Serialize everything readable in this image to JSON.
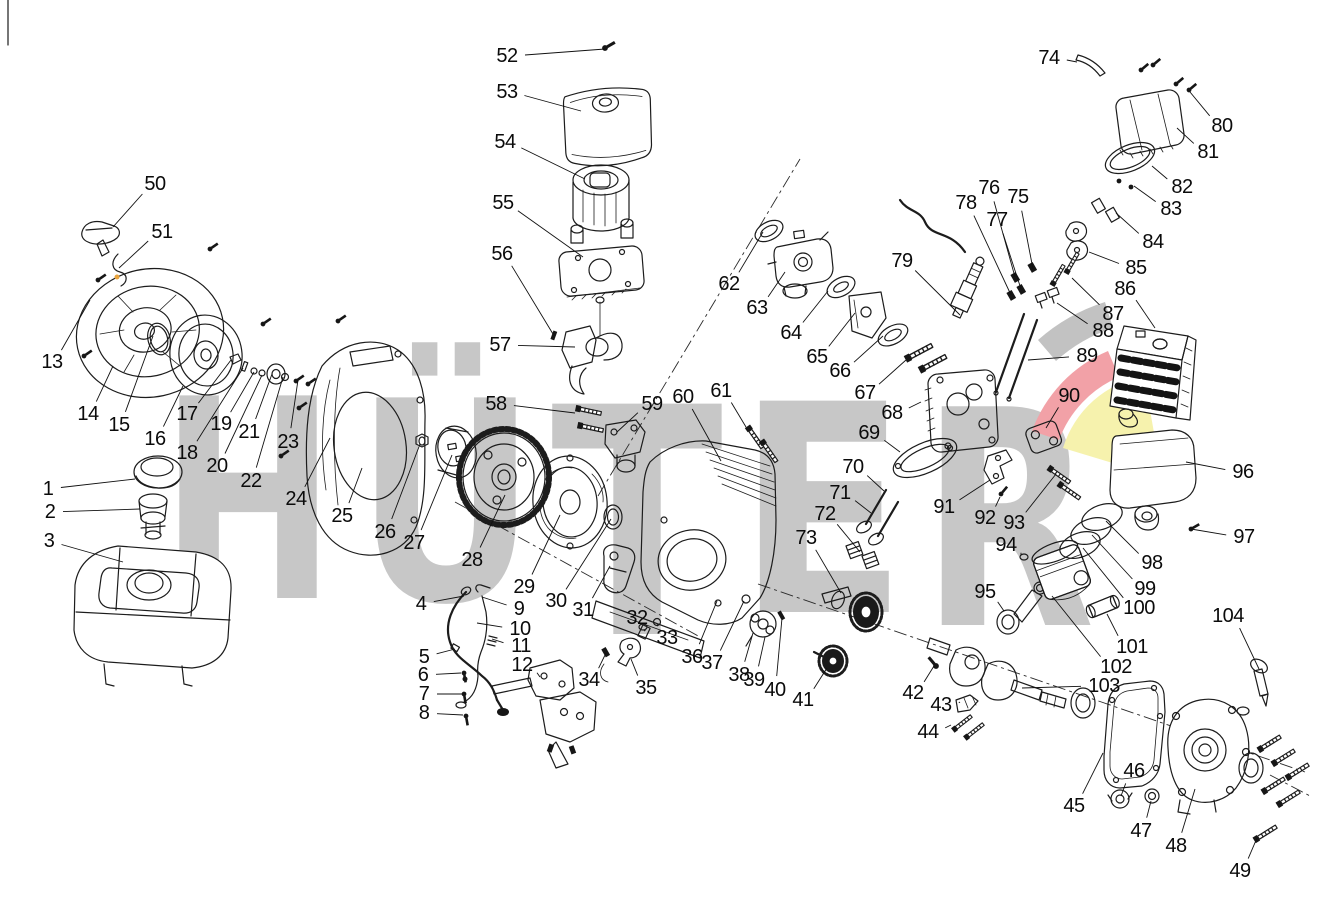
{
  "watermark": {
    "text": "HÜTER",
    "color": "#c7c7c7",
    "swoosh": {
      "gray": "#c2c2c2",
      "red": "#f2a1a7",
      "yellow": "#f6f2ad"
    },
    "letters": [
      {
        "ch": "H",
        "x": 160,
        "baseline": 598,
        "size": 278,
        "width": 176
      },
      {
        "ch": "Ü",
        "x": 356,
        "baseline": 600,
        "size": 278,
        "width": 180
      },
      {
        "ch": "T",
        "x": 551,
        "baseline": 634,
        "size": 316,
        "width": 172
      },
      {
        "ch": "E",
        "x": 737,
        "baseline": 612,
        "size": 290,
        "width": 170
      },
      {
        "ch": "R",
        "x": 921,
        "baseline": 625,
        "size": 300,
        "width": 174
      }
    ]
  },
  "diagram": {
    "background": "#ffffff",
    "stroke": "#1c1c1c",
    "label_font_px": 20,
    "parts": [
      {
        "n": "1",
        "x": 48,
        "y": 489,
        "tx": 135,
        "ty": 479
      },
      {
        "n": "2",
        "x": 50,
        "y": 512,
        "tx": 140,
        "ty": 509
      },
      {
        "n": "3",
        "x": 49,
        "y": 541,
        "tx": 123,
        "ty": 562
      },
      {
        "n": "4",
        "x": 421,
        "y": 604,
        "tx": 464,
        "ty": 596
      },
      {
        "n": "5",
        "x": 424,
        "y": 657,
        "tx": 455,
        "ty": 649
      },
      {
        "n": "6",
        "x": 423,
        "y": 675,
        "tx": 461,
        "ty": 673
      },
      {
        "n": "7",
        "x": 424,
        "y": 694,
        "tx": 462,
        "ty": 694
      },
      {
        "n": "8",
        "x": 424,
        "y": 713,
        "tx": 463,
        "ty": 715
      },
      {
        "n": "9",
        "x": 519,
        "y": 609,
        "tx": 482,
        "ty": 597
      },
      {
        "n": "10",
        "x": 520,
        "y": 629,
        "tx": 477,
        "ty": 623
      },
      {
        "n": "11",
        "x": 521,
        "y": 646,
        "tx": 492,
        "ty": 639
      },
      {
        "n": "12",
        "x": 522,
        "y": 665,
        "tx": 540,
        "ty": 677
      },
      {
        "n": "13",
        "x": 52,
        "y": 362,
        "tx": 90,
        "ty": 300
      },
      {
        "n": "14",
        "x": 88,
        "y": 414,
        "tx": 113,
        "ty": 366
      },
      {
        "n": "15",
        "x": 119,
        "y": 425,
        "tx": 153,
        "ty": 336
      },
      {
        "n": "16",
        "x": 155,
        "y": 439,
        "tx": 183,
        "ty": 386
      },
      {
        "n": "17",
        "x": 187,
        "y": 414,
        "tx": 231,
        "ty": 360
      },
      {
        "n": "18",
        "x": 187,
        "y": 453,
        "tx": 243,
        "ty": 368
      },
      {
        "n": "19",
        "x": 221,
        "y": 424,
        "tx": 254,
        "ty": 372
      },
      {
        "n": "20",
        "x": 217,
        "y": 466,
        "tx": 262,
        "ty": 375
      },
      {
        "n": "21",
        "x": 249,
        "y": 432,
        "tx": 272,
        "ty": 374
      },
      {
        "n": "22",
        "x": 251,
        "y": 481,
        "tx": 283,
        "ty": 377
      },
      {
        "n": "23",
        "x": 288,
        "y": 442,
        "tx": 298,
        "ty": 380
      },
      {
        "n": "24",
        "x": 296,
        "y": 499,
        "tx": 330,
        "ty": 438
      },
      {
        "n": "25",
        "x": 342,
        "y": 516,
        "tx": 362,
        "ty": 468
      },
      {
        "n": "26",
        "x": 385,
        "y": 532,
        "tx": 420,
        "ty": 444
      },
      {
        "n": "27",
        "x": 414,
        "y": 543,
        "tx": 452,
        "ty": 455
      },
      {
        "n": "28",
        "x": 472,
        "y": 560,
        "tx": 505,
        "ty": 495
      },
      {
        "n": "29",
        "x": 524,
        "y": 587,
        "tx": 560,
        "ty": 515
      },
      {
        "n": "30",
        "x": 556,
        "y": 601,
        "tx": 611,
        "ty": 519
      },
      {
        "n": "31",
        "x": 583,
        "y": 610,
        "tx": 610,
        "ty": 566
      },
      {
        "n": "32",
        "x": 637,
        "y": 618,
        "tx": 644,
        "ty": 631
      },
      {
        "n": "33",
        "x": 667,
        "y": 638,
        "tx": 658,
        "ty": 624
      },
      {
        "n": "34",
        "x": 589,
        "y": 680,
        "tx": 606,
        "ty": 653
      },
      {
        "n": "35",
        "x": 646,
        "y": 688,
        "tx": 631,
        "ty": 659
      },
      {
        "n": "36",
        "x": 692,
        "y": 657,
        "tx": 717,
        "ty": 601
      },
      {
        "n": "37",
        "x": 712,
        "y": 663,
        "tx": 744,
        "ty": 601
      },
      {
        "n": "38",
        "x": 739,
        "y": 675,
        "tx": 753,
        "ty": 633
      },
      {
        "n": "39",
        "x": 754,
        "y": 680,
        "tx": 765,
        "ty": 637
      },
      {
        "n": "40",
        "x": 775,
        "y": 690,
        "tx": 782,
        "ty": 618
      },
      {
        "n": "41",
        "x": 803,
        "y": 700,
        "tx": 827,
        "ty": 668
      },
      {
        "n": "42",
        "x": 913,
        "y": 693,
        "tx": 934,
        "ty": 666
      },
      {
        "n": "43",
        "x": 941,
        "y": 705,
        "tx": 960,
        "ty": 702
      },
      {
        "n": "44",
        "x": 928,
        "y": 732,
        "tx": 951,
        "ty": 725
      },
      {
        "n": "45",
        "x": 1074,
        "y": 806,
        "tx": 1103,
        "ty": 753
      },
      {
        "n": "46",
        "x": 1134,
        "y": 771,
        "tx": 1121,
        "ty": 796
      },
      {
        "n": "47",
        "x": 1141,
        "y": 831,
        "tx": 1151,
        "ty": 801
      },
      {
        "n": "48",
        "x": 1176,
        "y": 846,
        "tx": 1195,
        "ty": 789
      },
      {
        "n": "49",
        "x": 1240,
        "y": 871,
        "tx": 1257,
        "ty": 838
      },
      {
        "n": "50",
        "x": 155,
        "y": 184,
        "tx": 113,
        "ty": 227
      },
      {
        "n": "51",
        "x": 162,
        "y": 232,
        "tx": 119,
        "ty": 268
      },
      {
        "n": "52",
        "x": 507,
        "y": 56,
        "tx": 605,
        "ty": 49
      },
      {
        "n": "53",
        "x": 507,
        "y": 92,
        "tx": 581,
        "ty": 111
      },
      {
        "n": "54",
        "x": 505,
        "y": 142,
        "tx": 585,
        "ty": 179
      },
      {
        "n": "55",
        "x": 503,
        "y": 203,
        "tx": 583,
        "ty": 257
      },
      {
        "n": "56",
        "x": 502,
        "y": 254,
        "tx": 553,
        "ty": 334
      },
      {
        "n": "57",
        "x": 500,
        "y": 345,
        "tx": 575,
        "ty": 347
      },
      {
        "n": "58",
        "x": 496,
        "y": 404,
        "tx": 575,
        "ty": 413
      },
      {
        "n": "59",
        "x": 652,
        "y": 404,
        "tx": 617,
        "ty": 432
      },
      {
        "n": "60",
        "x": 683,
        "y": 397,
        "tx": 721,
        "ty": 461
      },
      {
        "n": "61",
        "x": 721,
        "y": 391,
        "tx": 746,
        "ty": 427
      },
      {
        "n": "62",
        "x": 729,
        "y": 284,
        "tx": 763,
        "ty": 232
      },
      {
        "n": "63",
        "x": 757,
        "y": 308,
        "tx": 785,
        "ty": 272
      },
      {
        "n": "64",
        "x": 791,
        "y": 333,
        "tx": 828,
        "ty": 291
      },
      {
        "n": "65",
        "x": 817,
        "y": 357,
        "tx": 855,
        "ty": 313
      },
      {
        "n": "66",
        "x": 840,
        "y": 371,
        "tx": 883,
        "ty": 336
      },
      {
        "n": "67",
        "x": 865,
        "y": 393,
        "tx": 906,
        "ty": 360
      },
      {
        "n": "68",
        "x": 892,
        "y": 413,
        "tx": 921,
        "ty": 402
      },
      {
        "n": "69",
        "x": 869,
        "y": 433,
        "tx": 900,
        "ty": 452
      },
      {
        "n": "70",
        "x": 853,
        "y": 467,
        "tx": 884,
        "ty": 491
      },
      {
        "n": "71",
        "x": 840,
        "y": 493,
        "tx": 871,
        "ty": 513
      },
      {
        "n": "72",
        "x": 825,
        "y": 514,
        "tx": 860,
        "ty": 552
      },
      {
        "n": "73",
        "x": 806,
        "y": 538,
        "tx": 841,
        "ty": 593
      },
      {
        "n": "74",
        "x": 1049,
        "y": 58,
        "tx": 1077,
        "ty": 62
      },
      {
        "n": "75",
        "x": 1018,
        "y": 197,
        "tx": 1033,
        "ty": 269
      },
      {
        "n": "76",
        "x": 989,
        "y": 188,
        "tx": 1015,
        "ty": 277
      },
      {
        "n": "77",
        "x": 997,
        "y": 220,
        "tx": 1021,
        "ty": 289
      },
      {
        "n": "78",
        "x": 966,
        "y": 203,
        "tx": 1011,
        "ty": 295
      },
      {
        "n": "79",
        "x": 902,
        "y": 261,
        "tx": 960,
        "ty": 315
      },
      {
        "n": "80",
        "x": 1222,
        "y": 126,
        "tx": 1190,
        "ty": 92
      },
      {
        "n": "81",
        "x": 1208,
        "y": 152,
        "tx": 1177,
        "ty": 128
      },
      {
        "n": "82",
        "x": 1182,
        "y": 187,
        "tx": 1152,
        "ty": 166
      },
      {
        "n": "83",
        "x": 1171,
        "y": 209,
        "tx": 1134,
        "ty": 186
      },
      {
        "n": "84",
        "x": 1153,
        "y": 242,
        "tx": 1116,
        "ty": 213
      },
      {
        "n": "85",
        "x": 1136,
        "y": 268,
        "tx": 1089,
        "ty": 252
      },
      {
        "n": "86",
        "x": 1125,
        "y": 289,
        "tx": 1155,
        "ty": 328
      },
      {
        "n": "87",
        "x": 1113,
        "y": 314,
        "tx": 1072,
        "ty": 278
      },
      {
        "n": "88",
        "x": 1103,
        "y": 331,
        "tx": 1057,
        "ty": 303
      },
      {
        "n": "89",
        "x": 1087,
        "y": 356,
        "tx": 1028,
        "ty": 360
      },
      {
        "n": "90",
        "x": 1069,
        "y": 396,
        "tx": 1046,
        "ty": 428
      },
      {
        "n": "91",
        "x": 944,
        "y": 507,
        "tx": 990,
        "ty": 480
      },
      {
        "n": "92",
        "x": 985,
        "y": 518,
        "tx": 1000,
        "ty": 497
      },
      {
        "n": "93",
        "x": 1014,
        "y": 523,
        "tx": 1056,
        "ty": 474
      },
      {
        "n": "94",
        "x": 1006,
        "y": 545,
        "tx": 1021,
        "ty": 555
      },
      {
        "n": "95",
        "x": 985,
        "y": 592,
        "tx": 1004,
        "ty": 611
      },
      {
        "n": "96",
        "x": 1243,
        "y": 472,
        "tx": 1186,
        "ty": 462
      },
      {
        "n": "97",
        "x": 1244,
        "y": 537,
        "tx": 1191,
        "ty": 529
      },
      {
        "n": "98",
        "x": 1152,
        "y": 563,
        "tx": 1106,
        "ty": 521
      },
      {
        "n": "99",
        "x": 1145,
        "y": 589,
        "tx": 1092,
        "ty": 535
      },
      {
        "n": "100",
        "x": 1139,
        "y": 608,
        "tx": 1083,
        "ty": 548
      },
      {
        "n": "101",
        "x": 1132,
        "y": 647,
        "tx": 1107,
        "ty": 614
      },
      {
        "n": "102",
        "x": 1116,
        "y": 667,
        "tx": 1052,
        "ty": 596
      },
      {
        "n": "103",
        "x": 1104,
        "y": 686,
        "tx": 1022,
        "ty": 688
      },
      {
        "n": "104",
        "x": 1228,
        "y": 616,
        "tx": 1259,
        "ty": 669
      }
    ]
  }
}
